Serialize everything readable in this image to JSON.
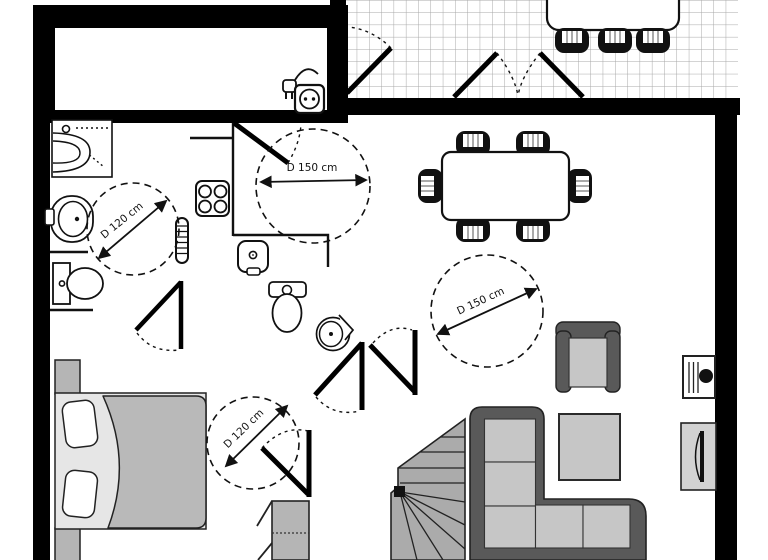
{
  "document": {
    "type": "architectural floor plan",
    "style": "black-and-white plan with accessibility clearance circles"
  },
  "annotations": {
    "clearance_circles": [
      {
        "id": "kitchen-hall-circle",
        "label": "D 150 cm"
      },
      {
        "id": "living-room-circle",
        "label": "D 150 cm"
      },
      {
        "id": "bathroom-circle",
        "label": "D 120 cm"
      },
      {
        "id": "bedroom-circle",
        "label": "D 120 cm"
      }
    ]
  },
  "colors": {
    "wall": "#000000",
    "grid_line": "#a8a8a8",
    "stairs": "#ababab",
    "sofa_frame": "#595959",
    "cushion": "#c6c6c6",
    "duvet": "#b9b9b9",
    "bed_base": "#e6e6e6",
    "nightstand": "#b5b5b5",
    "wardrobe": "#b5b5b5",
    "tv_cabinet": "#d2d2d2",
    "chair": "#111111"
  },
  "elements": {
    "terrace": [
      "tiled floor",
      "outdoor table",
      "3 outdoor chairs",
      "single door",
      "double french door"
    ],
    "dining": [
      "dining table",
      "6 chairs"
    ],
    "kitchen": [
      "stove 4 burners",
      "counter",
      "small sink",
      "towel radiator",
      "door"
    ],
    "bathroom": [
      "shower",
      "washbasin",
      "toilet",
      "door"
    ],
    "wc": [
      "toilet",
      "corner basin"
    ],
    "bedroom": [
      "double bed",
      "2 pillows",
      "2 nightstands",
      "wardrobe",
      "door"
    ],
    "living": [
      "corner sofa",
      "coffee table",
      "armchair",
      "tv cabinet",
      "heater unit",
      "winder staircase"
    ],
    "storage_room": [
      "power outlet symbol"
    ]
  }
}
